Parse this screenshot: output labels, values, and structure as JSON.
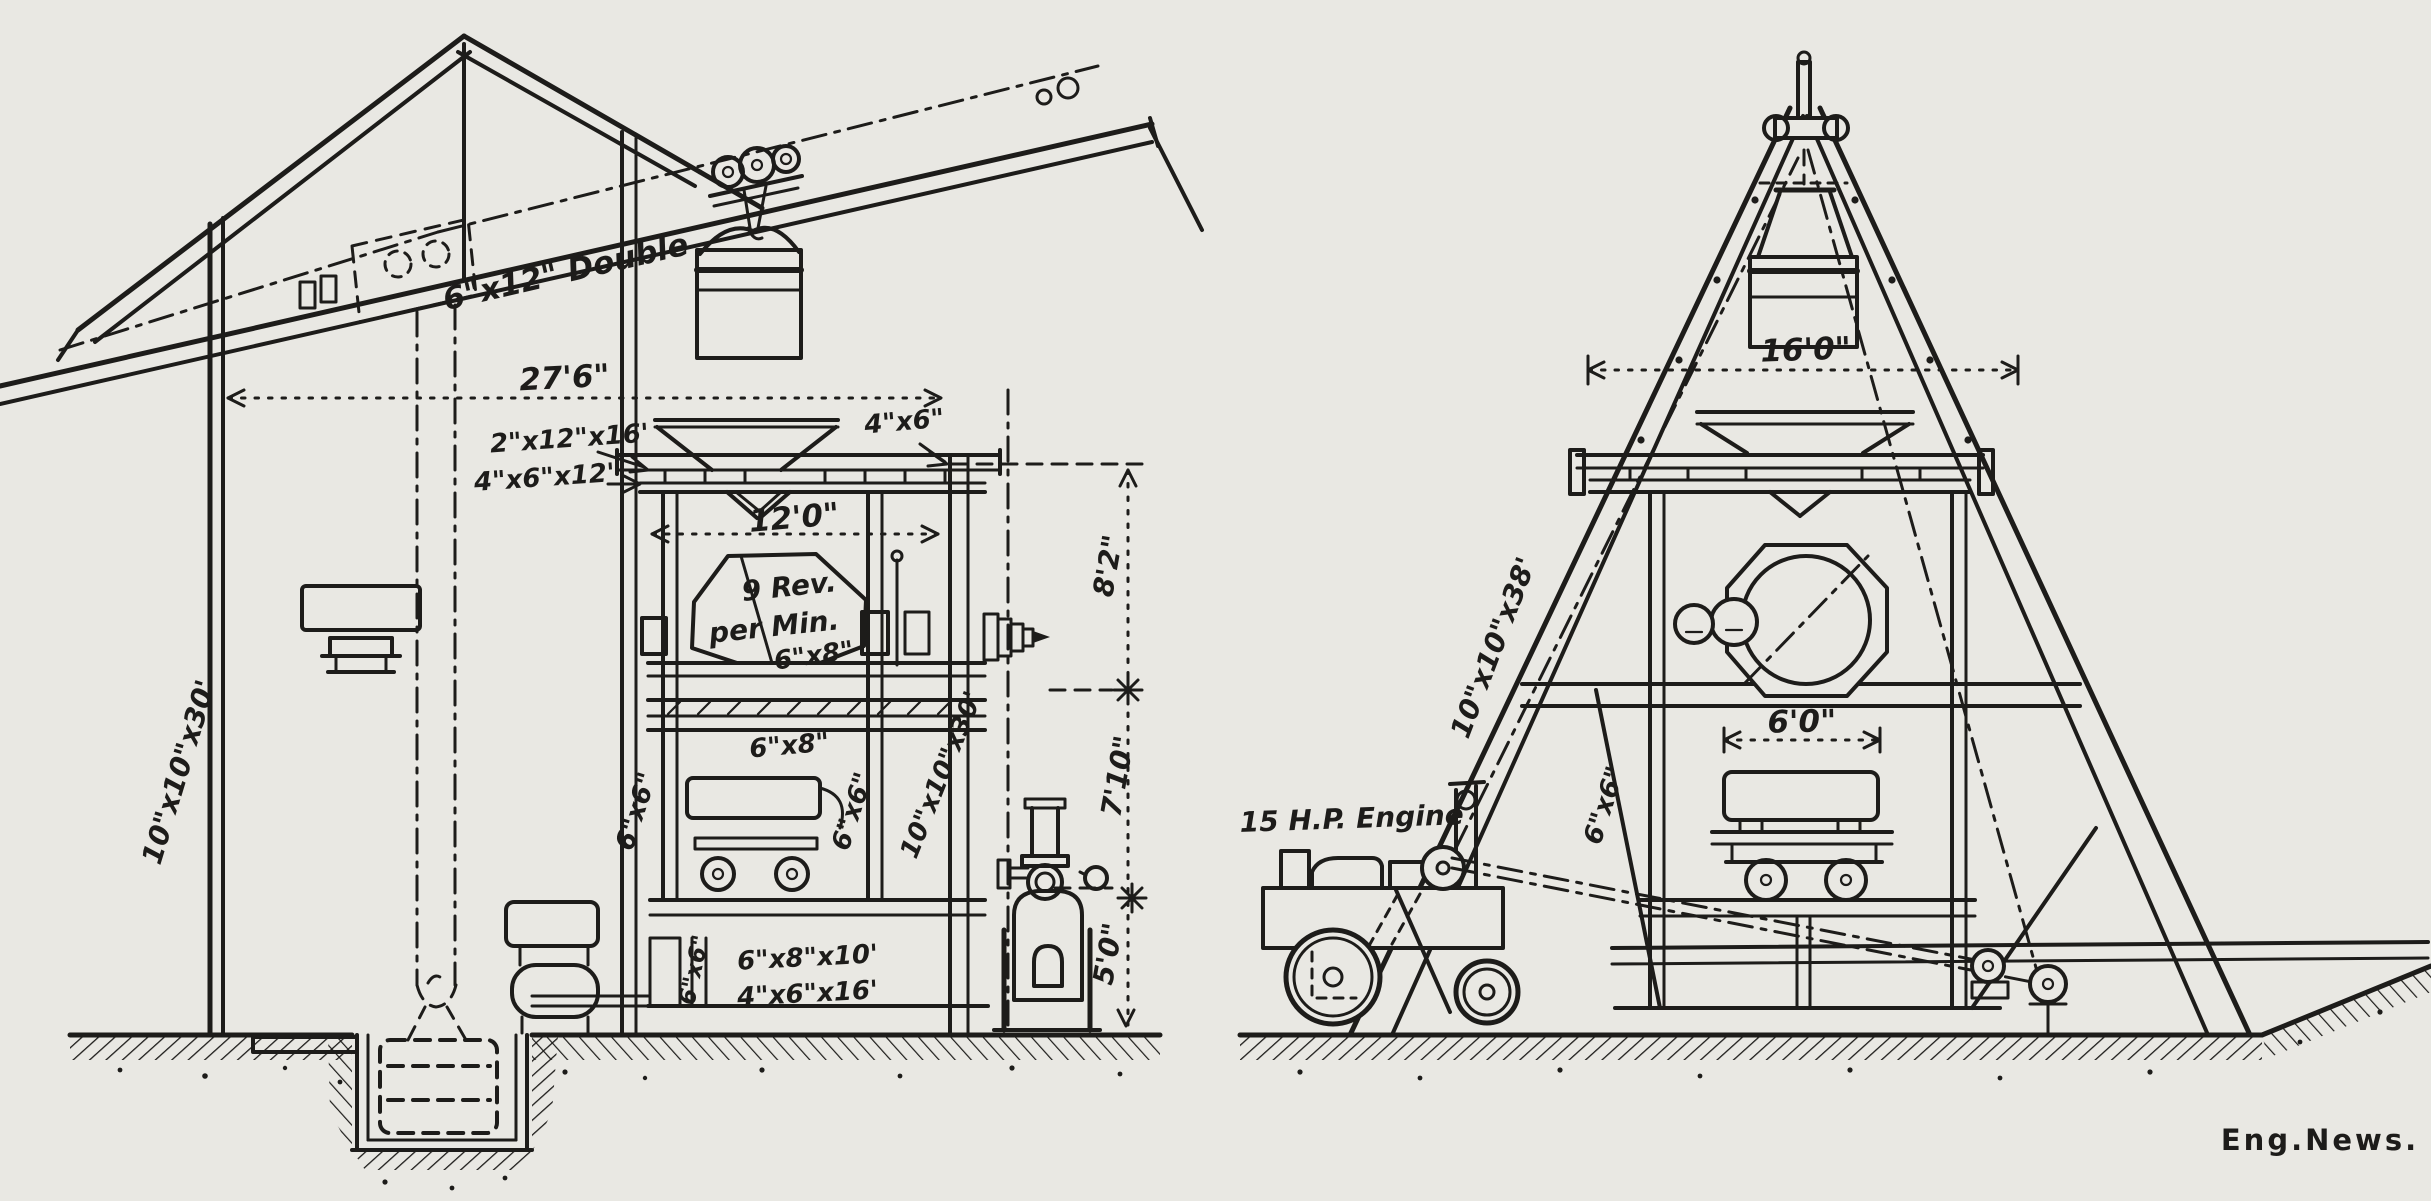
{
  "figure": {
    "credit": "Eng.News.",
    "side_view": {
      "labels": {
        "boom": "6\"x12\" Double",
        "span_dim": "27'6\"",
        "platform_joists": "2\"x12\"x16'",
        "platform_beams": "4\"x6\"x12'",
        "tower_width_dim": "12'0\"",
        "mixer_rev_line1": "9 Rev.",
        "mixer_rev_line2": "per Min.",
        "shaft_beam": "6\"x8\"",
        "floor_beam": "6\"x8\"",
        "post_left": "6\"x6\"",
        "post_right": "6\"x6\"",
        "pole_left": "10\"x10\"x30'",
        "pole_right": "10\"x10\"x30'",
        "cap_beam": "4\"x6\"",
        "height_upper": "8'2\"",
        "height_middle": "7'10\"",
        "height_lower": "5'0\"",
        "sill_a": "6\"x8\"x10'",
        "sill_b": "4\"x6\"x16'",
        "sill_post": "6\"x6\""
      }
    },
    "end_view": {
      "labels": {
        "span_dim": "16'0\"",
        "leg": "10\"x10\"x38'",
        "engine": "15 H.P. Engine",
        "brace": "6\"x6\"",
        "cart_dim": "6'0\""
      }
    }
  }
}
